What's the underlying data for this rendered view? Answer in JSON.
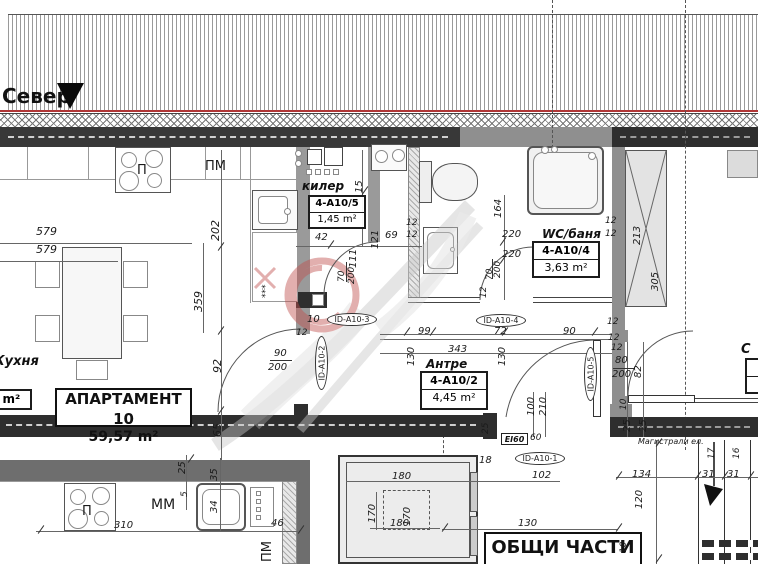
{
  "colors": {
    "wall_dark": "#383838",
    "wall_mid": "#8f8f8f",
    "wall_grey": "#6e6e6e",
    "red_line": "#b03636",
    "watermark_red": "#c0504d",
    "line": "#444444",
    "text": "#1a1a1a"
  },
  "north": {
    "label": "Север"
  },
  "apartment": {
    "title": "АПАРТАМЕНТ 10",
    "area": "59,57 m²"
  },
  "kitchen": {
    "name": "Кухня",
    "area": "35 m²"
  },
  "common_area": {
    "title": "ОБЩИ ЧАСТИ",
    "area": "24,10 m²"
  },
  "entrance": {
    "fire_rating": "EI60",
    "width": "60"
  },
  "utilities_note": "Магистрали ел.",
  "rooms": [
    {
      "name": "килер",
      "id": "4-А10/5",
      "area": "1,45 m²"
    },
    {
      "name": "WC/баня",
      "id": "4-А10/4",
      "area": "3,63 m²"
    },
    {
      "name": "Антре",
      "id": "4-А10/2",
      "area": "4,45 m²"
    },
    {
      "name": "С",
      "id": "",
      "area": ""
    }
  ],
  "id_tags": [
    {
      "t": "ID-А10-3",
      "x": 327,
      "y": 313,
      "v": false
    },
    {
      "t": "ID-А10-4",
      "x": 476,
      "y": 314,
      "v": false
    },
    {
      "t": "ID-А10-1",
      "x": 515,
      "y": 452,
      "v": false
    },
    {
      "t": "ID-А10-2",
      "x": 315,
      "y": 336,
      "v": true
    },
    {
      "t": "ID-А10-5",
      "x": 584,
      "y": 347,
      "v": true
    }
  ],
  "annotations": [
    {
      "t": "579",
      "x": 36,
      "y": 226,
      "r": 0,
      "s": 11
    },
    {
      "t": "579",
      "x": 36,
      "y": 244,
      "r": 0,
      "s": 11
    },
    {
      "t": "202",
      "x": 210,
      "y": 241,
      "r": -90,
      "s": 11
    },
    {
      "t": "359",
      "x": 193,
      "y": 312,
      "r": -90,
      "s": 11
    },
    {
      "t": "92",
      "x": 212,
      "y": 373,
      "r": -90,
      "s": 11
    },
    {
      "t": "65",
      "x": 212,
      "y": 437,
      "r": -90,
      "s": 11
    },
    {
      "t": "90",
      "x": 274,
      "y": 349,
      "r": 0,
      "s": 10
    },
    {
      "t": "200",
      "x": 268,
      "y": 363,
      "r": 0,
      "s": 10
    },
    {
      "t": "42",
      "x": 315,
      "y": 233,
      "r": 0,
      "s": 10
    },
    {
      "t": "121",
      "x": 371,
      "y": 249,
      "r": -90,
      "s": 10
    },
    {
      "t": "69",
      "x": 385,
      "y": 231,
      "r": 0,
      "s": 10
    },
    {
      "t": "111",
      "x": 349,
      "y": 268,
      "r": -90,
      "s": 10
    },
    {
      "t": "70",
      "x": 338,
      "y": 282,
      "r": -90,
      "s": 9
    },
    {
      "t": "200",
      "x": 348,
      "y": 284,
      "r": -90,
      "s": 9
    },
    {
      "t": "15",
      "x": 355,
      "y": 193,
      "r": -90,
      "s": 10
    },
    {
      "t": "12",
      "x": 406,
      "y": 219,
      "r": 0,
      "s": 9
    },
    {
      "t": "12",
      "x": 406,
      "y": 231,
      "r": 0,
      "s": 9
    },
    {
      "t": "12",
      "x": 296,
      "y": 329,
      "r": 0,
      "s": 9
    },
    {
      "t": "10",
      "x": 307,
      "y": 315,
      "r": 0,
      "s": 10
    },
    {
      "t": "164",
      "x": 494,
      "y": 218,
      "r": -90,
      "s": 10
    },
    {
      "t": "220",
      "x": 502,
      "y": 230,
      "r": 0,
      "s": 10
    },
    {
      "t": "220",
      "x": 502,
      "y": 250,
      "r": 0,
      "s": 10
    },
    {
      "t": "200",
      "x": 494,
      "y": 278,
      "r": -90,
      "s": 9
    },
    {
      "t": "70",
      "x": 486,
      "y": 280,
      "r": -90,
      "s": 9
    },
    {
      "t": "12",
      "x": 480,
      "y": 298,
      "r": -90,
      "s": 9
    },
    {
      "t": "12",
      "x": 605,
      "y": 217,
      "r": 0,
      "s": 9
    },
    {
      "t": "12",
      "x": 605,
      "y": 230,
      "r": 0,
      "s": 9
    },
    {
      "t": "213",
      "x": 633,
      "y": 245,
      "r": -90,
      "s": 10
    },
    {
      "t": "305",
      "x": 651,
      "y": 291,
      "r": -90,
      "s": 10
    },
    {
      "t": "12",
      "x": 607,
      "y": 318,
      "r": 0,
      "s": 9
    },
    {
      "t": "12",
      "x": 608,
      "y": 334,
      "r": 0,
      "s": 9
    },
    {
      "t": "12",
      "x": 611,
      "y": 344,
      "r": 0,
      "s": 9
    },
    {
      "t": "99",
      "x": 418,
      "y": 327,
      "r": 0,
      "s": 10
    },
    {
      "t": "72",
      "x": 494,
      "y": 327,
      "r": 0,
      "s": 10
    },
    {
      "t": "90",
      "x": 563,
      "y": 327,
      "r": 0,
      "s": 10
    },
    {
      "t": "343",
      "x": 448,
      "y": 345,
      "r": 0,
      "s": 10
    },
    {
      "t": "130",
      "x": 407,
      "y": 366,
      "r": -90,
      "s": 10
    },
    {
      "t": "130",
      "x": 498,
      "y": 366,
      "r": -90,
      "s": 10
    },
    {
      "t": "100",
      "x": 527,
      "y": 416,
      "r": -90,
      "s": 10
    },
    {
      "t": "210",
      "x": 539,
      "y": 416,
      "r": -90,
      "s": 10
    },
    {
      "t": "60",
      "x": 530,
      "y": 434,
      "r": 0,
      "s": 9
    },
    {
      "t": "102",
      "x": 532,
      "y": 471,
      "r": 0,
      "s": 10
    },
    {
      "t": "18",
      "x": 479,
      "y": 456,
      "r": 0,
      "s": 10
    },
    {
      "t": "25",
      "x": 482,
      "y": 434,
      "r": -90,
      "s": 9
    },
    {
      "t": "80",
      "x": 615,
      "y": 356,
      "r": 0,
      "s": 10
    },
    {
      "t": "200",
      "x": 612,
      "y": 370,
      "r": 0,
      "s": 10
    },
    {
      "t": "82",
      "x": 634,
      "y": 378,
      "r": -90,
      "s": 10
    },
    {
      "t": "10",
      "x": 620,
      "y": 410,
      "r": -90,
      "s": 9
    },
    {
      "t": "25",
      "x": 623,
      "y": 432,
      "r": -90,
      "s": 10
    },
    {
      "t": "25",
      "x": 639,
      "y": 432,
      "r": -90,
      "s": 10
    },
    {
      "t": "134",
      "x": 632,
      "y": 470,
      "r": 0,
      "s": 10
    },
    {
      "t": "120",
      "x": 635,
      "y": 509,
      "r": -90,
      "s": 10
    },
    {
      "t": "10",
      "x": 620,
      "y": 553,
      "r": -90,
      "s": 9
    },
    {
      "t": "31",
      "x": 702,
      "y": 470,
      "r": 0,
      "s": 10
    },
    {
      "t": "31",
      "x": 727,
      "y": 470,
      "r": 0,
      "s": 10
    },
    {
      "t": "17",
      "x": 708,
      "y": 459,
      "r": -90,
      "s": 9
    },
    {
      "t": "16",
      "x": 733,
      "y": 459,
      "r": -90,
      "s": 9
    },
    {
      "t": "180",
      "x": 392,
      "y": 472,
      "r": 0,
      "s": 10
    },
    {
      "t": "170",
      "x": 368,
      "y": 523,
      "r": -90,
      "s": 10
    },
    {
      "t": "170",
      "x": 403,
      "y": 526,
      "r": -90,
      "s": 10
    },
    {
      "t": "180",
      "x": 390,
      "y": 519,
      "r": 0,
      "s": 10
    },
    {
      "t": "130",
      "x": 518,
      "y": 519,
      "r": 0,
      "s": 10
    },
    {
      "t": "310",
      "x": 114,
      "y": 521,
      "r": 0,
      "s": 10
    },
    {
      "t": "46",
      "x": 271,
      "y": 519,
      "r": 0,
      "s": 10
    },
    {
      "t": "25",
      "x": 178,
      "y": 474,
      "r": -90,
      "s": 10
    },
    {
      "t": "5",
      "x": 181,
      "y": 497,
      "r": -90,
      "s": 9
    },
    {
      "t": "35",
      "x": 210,
      "y": 481,
      "r": -90,
      "s": 10
    },
    {
      "t": "34",
      "x": 210,
      "y": 513,
      "r": -90,
      "s": 10
    },
    {
      "t": "ПМ",
      "x": 205,
      "y": 160,
      "r": 0,
      "s": 13,
      "c": "p"
    },
    {
      "t": "П",
      "x": 137,
      "y": 164,
      "r": 0,
      "s": 13,
      "c": "p"
    },
    {
      "t": "ММ",
      "x": 151,
      "y": 498,
      "r": 0,
      "s": 14,
      "c": "p"
    },
    {
      "t": "П",
      "x": 82,
      "y": 505,
      "r": 0,
      "s": 13,
      "c": "p"
    },
    {
      "t": "ПМ",
      "x": 261,
      "y": 562,
      "r": -90,
      "s": 13,
      "c": "p"
    },
    {
      "t": "***",
      "x": 262,
      "y": 298,
      "r": -90,
      "s": 9,
      "c": "p"
    },
    {
      "t": "Магистрали ел.",
      "x": 638,
      "y": 438,
      "r": 0,
      "s": 8
    }
  ]
}
